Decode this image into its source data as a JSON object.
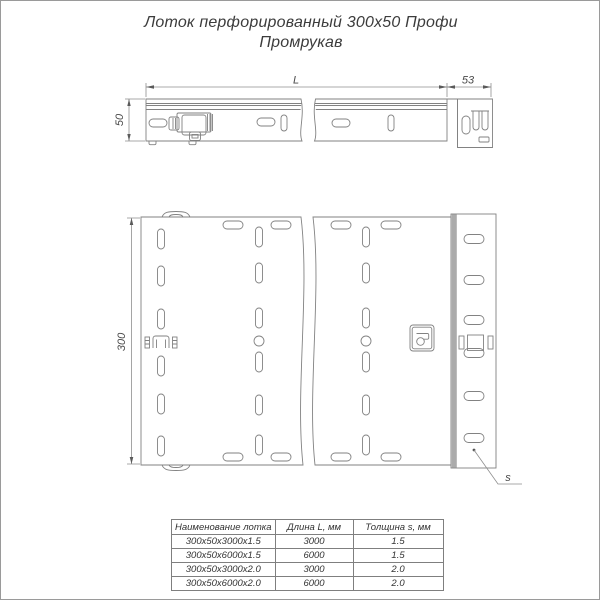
{
  "title": {
    "line1": "Лоток перфорированный 300x50 Профи",
    "line2": "Промрукав"
  },
  "drawing": {
    "dim_length_label": "L",
    "dim_end_length": "53",
    "dim_height": "50",
    "dim_width": "300",
    "dim_thickness_label": "s",
    "colors": {
      "line": "#828282",
      "dimension_text": "#4a4a4a",
      "connector_band": "#ababab"
    }
  },
  "table": {
    "headers": [
      "Наименование лотка",
      "Длина L, мм",
      "Толщина s, мм"
    ],
    "rows": [
      {
        "name": "300x50x3000x1.5",
        "length": "3000",
        "thickness": "1.5"
      },
      {
        "name": "300x50x6000x1.5",
        "length": "6000",
        "thickness": "1.5"
      },
      {
        "name": "300x50x3000x2.0",
        "length": "3000",
        "thickness": "2.0"
      },
      {
        "name": "300x50x6000x2.0",
        "length": "6000",
        "thickness": "2.0"
      }
    ]
  }
}
